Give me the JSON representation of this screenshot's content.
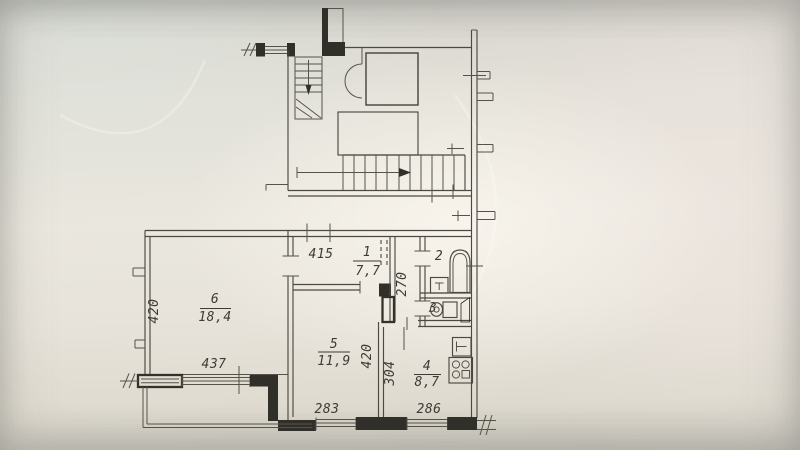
{
  "floor_plan": {
    "rooms": {
      "hallway": {
        "number": "1",
        "area": "7,7"
      },
      "bathroom": {
        "number": "2"
      },
      "wc": {
        "number": "3"
      },
      "kitchen": {
        "number": "4",
        "area": "8,7"
      },
      "bedroom": {
        "number": "5",
        "area": "11,9"
      },
      "living_room": {
        "number": "6",
        "area": "18,4"
      }
    },
    "dimensions": {
      "hallway_width": "415",
      "inner_hall_depth": "270",
      "living_room_depth": "420",
      "living_room_width": "437",
      "bedroom_depth": "420",
      "bedroom_window_width": "283",
      "kitchen_depth": "304",
      "kitchen_window_width": "286"
    },
    "fixtures": [
      "bathtub-icon",
      "wash-basin-icon",
      "toilet-icon",
      "kitchen-sink-icon",
      "stove-icon",
      "vent-shaft-icon",
      "staircase-icon",
      "entrance-stairs-icon",
      "door-swing-icon",
      "elevator-shaft",
      "balcony"
    ],
    "colors": {
      "paper": "#eae7de",
      "line": "#4c4942",
      "wall": "#312f2a",
      "text": "#3d3b35"
    }
  }
}
